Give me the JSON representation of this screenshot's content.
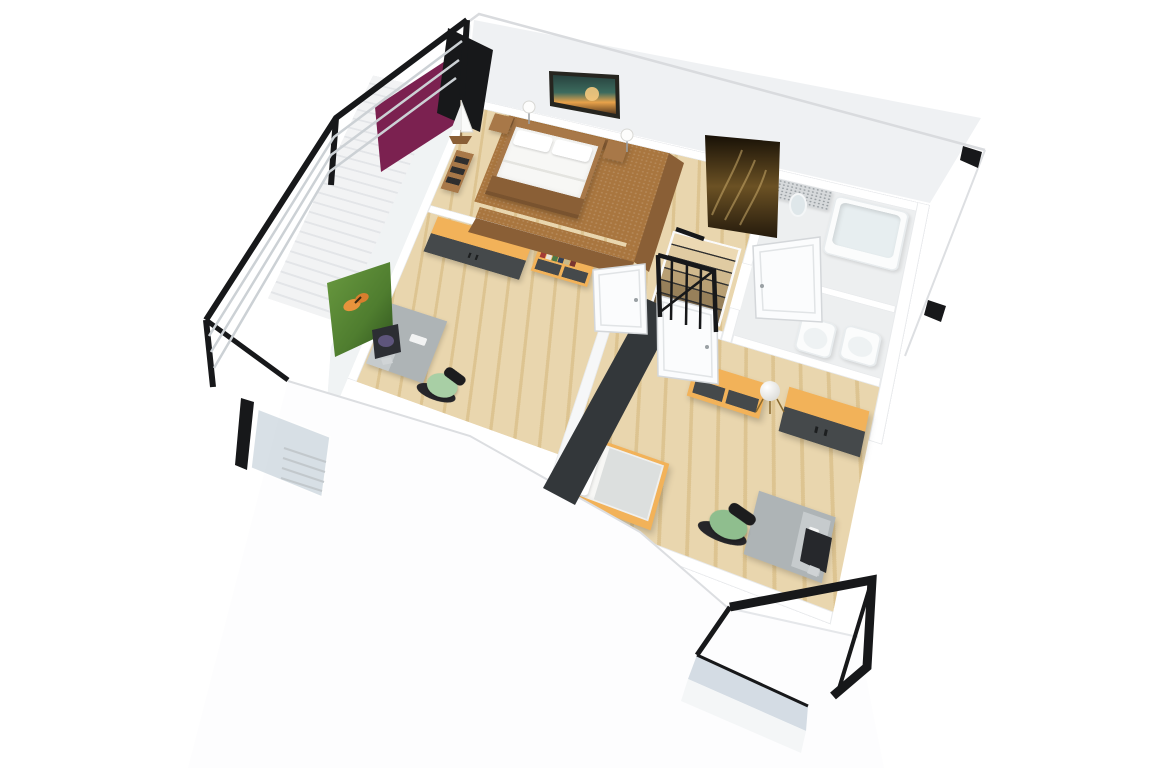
{
  "image": {
    "kind": "3d-floor-plan-render",
    "style": "isometric cutaway dollhouse view, white background",
    "level": "upper floor of a two-storey apartment"
  },
  "palette": {
    "white": "#ffffff",
    "wallTint": "#eff1f3",
    "wallEdge": "#d9dbde",
    "woodLight": "#e9d6ae",
    "woodPlank": "#ddc491",
    "carpet": "#a9763f",
    "brown": "#a87848",
    "brownDark": "#8a5f36",
    "purple": "#7b2150",
    "orange": "#f2b259",
    "slate": "#45494b",
    "slateDark": "#33373a",
    "deskGray": "#aeb4b6",
    "deskLight": "#c6cbcd",
    "mint": "#a8cfa5",
    "green": "#8fbe8e",
    "black": "#17181a",
    "glass": "#b9c7d2",
    "bathFloor": "#edeff0",
    "counter": "#d6d9db",
    "artGold": "#8a6a2f",
    "artDark": "#171006",
    "leafGreen": "#55852f",
    "leafDark": "#2e521d",
    "butterflyOrange": "#e8933c",
    "sunsetTeal": "#32605a",
    "sunsetOrange": "#e8a24a",
    "rugBeige": "#d8c49a"
  },
  "rooms": [
    {
      "id": "master-bedroom",
      "label": "Master bedroom",
      "floor": "light oak with brown carpet around bed",
      "accent_wall": "purple",
      "furniture": [
        "double bed with brown frame",
        "brown headboard panel",
        "two nightstands with white lamps",
        "landscape picture above bed",
        "side table with model sailboat",
        "brown knee walls"
      ]
    },
    {
      "id": "hallway",
      "label": "Hallway landing",
      "floor": "light oak",
      "furniture": [
        "staircase opening",
        "black steel stair railing",
        "gold grass artwork",
        "beige rug"
      ]
    },
    {
      "id": "bathroom",
      "label": "Bathroom",
      "floor": "light grey tile",
      "furniture": [
        "vanity counter with speckled top",
        "round mirror",
        "bathtub",
        "toilet",
        "bidet"
      ]
    },
    {
      "id": "study",
      "label": "Study room",
      "floor": "light oak",
      "furniture": [
        "orange wardrobe with dark grey doors",
        "low sideboard with books on top",
        "grey desk with iMac",
        "office chair with mint seat",
        "butterfly picture",
        "white panel door"
      ]
    },
    {
      "id": "bedroom-2",
      "label": "Second bedroom",
      "floor": "light oak",
      "accent_wall": "dark grey",
      "furniture": [
        "single bed with orange frame",
        "sideboard with white sphere lamp",
        "orange wardrobe with dark grey doors",
        "grey desk with iMac",
        "office chair with green seat",
        "dark framed artwork",
        "white panel door"
      ]
    }
  ],
  "balconies": [
    {
      "id": "balcony-west",
      "label": "West balcony",
      "railing": "black steel frame with light horizontal rails"
    },
    {
      "id": "balcony-south",
      "label": "South balcony",
      "railing": "black steel frame with blue-grey glass panel"
    }
  ]
}
